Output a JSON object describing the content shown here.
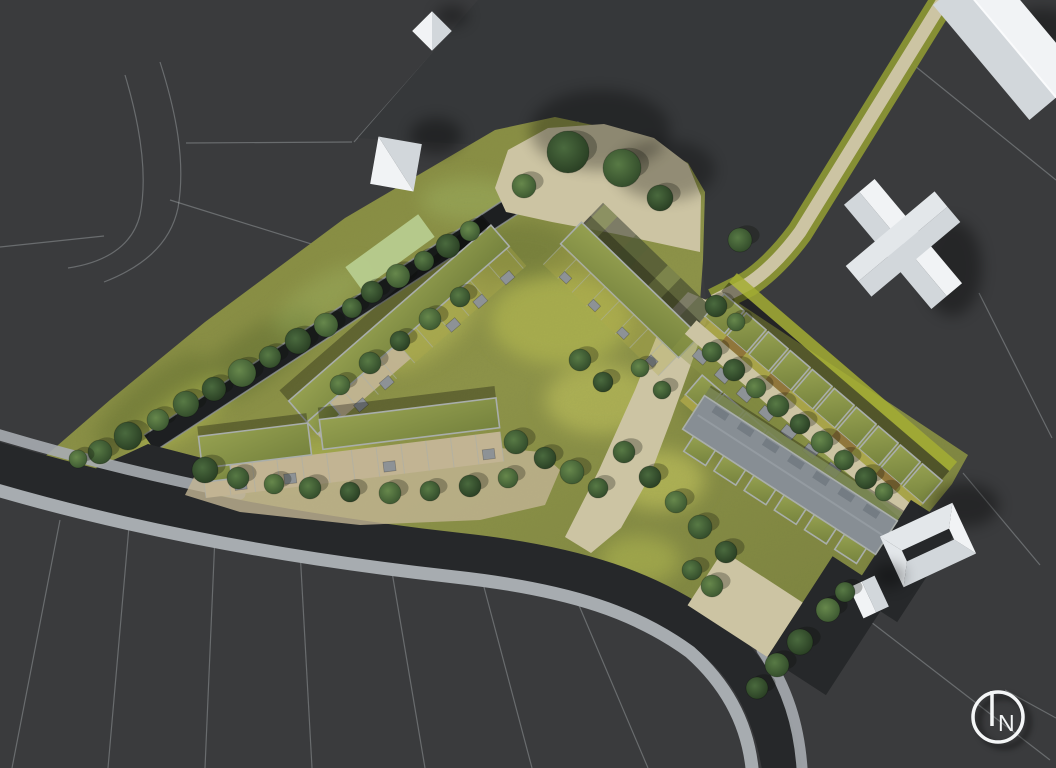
{
  "meta": {
    "title": "Residential development site plan — aerial masterplan rendering",
    "compass_label": "N"
  },
  "palette": {
    "bg": "#3a3b3d",
    "bg_parcel": "#36383a",
    "parcel_line": "#cdd2d6",
    "road": "#26282a",
    "sidewalk": "#a7acb0",
    "canal": "#1d1f21",
    "canal_edge": "#8e9396",
    "grass_a": "#878c42",
    "grass_b": "#8f954a",
    "grass_c": "#7c8340",
    "grass_panel": "#b9cf92",
    "blob_yellow": "#c9cf57",
    "blob_bright": "#dede68",
    "blob_dark": "#5c6b2e",
    "blob_fresh": "#aac46c",
    "path_beige": "#ccc4a3",
    "terrace": "#c2b493",
    "roof_g1": "#95a050",
    "roof_g2": "#76833e",
    "roof_edge": "#a9aeab",
    "roof_gray": "#878e94",
    "roof_gray_hi": "#9aa1a7",
    "dormer": "#747c83",
    "verge_bright": "#a3ad33",
    "verge_light": "#b3c47e",
    "verge_soft": "#8a9334",
    "front_a": "#b0a94a",
    "front_b": "#8c6f3a",
    "shed": "#8d9296",
    "white_hi": "#f1f3f5",
    "white_mid": "#e3e7ea",
    "white_lo": "#d2d7db",
    "compass": "#f4f6f7",
    "tree0a": "#4a6a3e",
    "tree0b": "#24381f",
    "tree1a": "#587a45",
    "tree1b": "#2c4426",
    "tree2a": "#67884c",
    "tree2b": "#35502c",
    "tree3a": "#7a9a55",
    "tree3b": "#3f5c33"
  },
  "scene": {
    "trees": [
      [
        100,
        452,
        12,
        1
      ],
      [
        128,
        436,
        14,
        0
      ],
      [
        158,
        420,
        11,
        2
      ],
      [
        186,
        404,
        13,
        1
      ],
      [
        214,
        389,
        12,
        0
      ],
      [
        242,
        373,
        14,
        2
      ],
      [
        270,
        357,
        11,
        1
      ],
      [
        298,
        341,
        13,
        0
      ],
      [
        326,
        325,
        12,
        2
      ],
      [
        352,
        308,
        10,
        1
      ],
      [
        78,
        459,
        9,
        2
      ],
      [
        372,
        292,
        11,
        0
      ],
      [
        398,
        276,
        12,
        2
      ],
      [
        424,
        261,
        10,
        1
      ],
      [
        448,
        246,
        12,
        0
      ],
      [
        470,
        231,
        10,
        2
      ],
      [
        340,
        385,
        10,
        2
      ],
      [
        370,
        363,
        11,
        1
      ],
      [
        400,
        341,
        10,
        0
      ],
      [
        430,
        319,
        11,
        2
      ],
      [
        460,
        297,
        10,
        1
      ],
      [
        568,
        152,
        21,
        0
      ],
      [
        622,
        168,
        19,
        1
      ],
      [
        660,
        198,
        13,
        0
      ],
      [
        524,
        186,
        12,
        2
      ],
      [
        740,
        240,
        12,
        1
      ],
      [
        205,
        470,
        13,
        0
      ],
      [
        238,
        478,
        11,
        1
      ],
      [
        274,
        484,
        10,
        2
      ],
      [
        310,
        488,
        11,
        1
      ],
      [
        350,
        492,
        10,
        0
      ],
      [
        390,
        493,
        11,
        2
      ],
      [
        430,
        491,
        10,
        1
      ],
      [
        470,
        486,
        11,
        0
      ],
      [
        508,
        478,
        10,
        2
      ],
      [
        580,
        360,
        11,
        1
      ],
      [
        603,
        382,
        10,
        0
      ],
      [
        516,
        442,
        12,
        1
      ],
      [
        545,
        458,
        11,
        0
      ],
      [
        572,
        472,
        12,
        2
      ],
      [
        598,
        488,
        10,
        1
      ],
      [
        640,
        368,
        9,
        2
      ],
      [
        662,
        390,
        9,
        1
      ],
      [
        624,
        452,
        11,
        1
      ],
      [
        650,
        477,
        11,
        0
      ],
      [
        676,
        502,
        11,
        2
      ],
      [
        700,
        527,
        12,
        1
      ],
      [
        726,
        552,
        11,
        0
      ],
      [
        712,
        352,
        10,
        1
      ],
      [
        734,
        370,
        11,
        0
      ],
      [
        756,
        388,
        10,
        2
      ],
      [
        778,
        406,
        11,
        1
      ],
      [
        800,
        424,
        10,
        0
      ],
      [
        822,
        442,
        11,
        2
      ],
      [
        844,
        460,
        10,
        1
      ],
      [
        866,
        478,
        11,
        0
      ],
      [
        884,
        492,
        9,
        2
      ],
      [
        716,
        306,
        11,
        0
      ],
      [
        736,
        322,
        9,
        2
      ],
      [
        777,
        665,
        12,
        1
      ],
      [
        800,
        642,
        13,
        0
      ],
      [
        828,
        610,
        12,
        2
      ],
      [
        845,
        592,
        10,
        1
      ],
      [
        757,
        688,
        11,
        0
      ],
      [
        712,
        586,
        11,
        2
      ],
      [
        692,
        570,
        10,
        1
      ]
    ],
    "parcel_lines": [
      "M125,75 C140,125 148,175 140,215 C132,248 102,263 68,268",
      "M160,62 C176,112 186,162 178,208 C170,246 140,268 104,282",
      "M186,143 L352,142",
      "M170,200 L350,256",
      "M0,247 L104,236",
      "M478,2 L354,142",
      "M560,150 L655,0",
      "M680,205 L775,60",
      "M850,12 L910,62 L1056,180",
      "M910,62 L876,132",
      "M700,2 L764,58",
      "M979,293 L1052,438",
      "M963,473 L1040,565",
      "M845,602 L1050,760",
      "M60,520 L12,768",
      "M130,515 L108,768",
      "M215,535 L205,768",
      "M300,550 L312,768",
      "M390,560 L425,768",
      "M480,572 L532,768",
      "M575,596 L648,768",
      "M1005,690 L1056,718"
    ]
  }
}
